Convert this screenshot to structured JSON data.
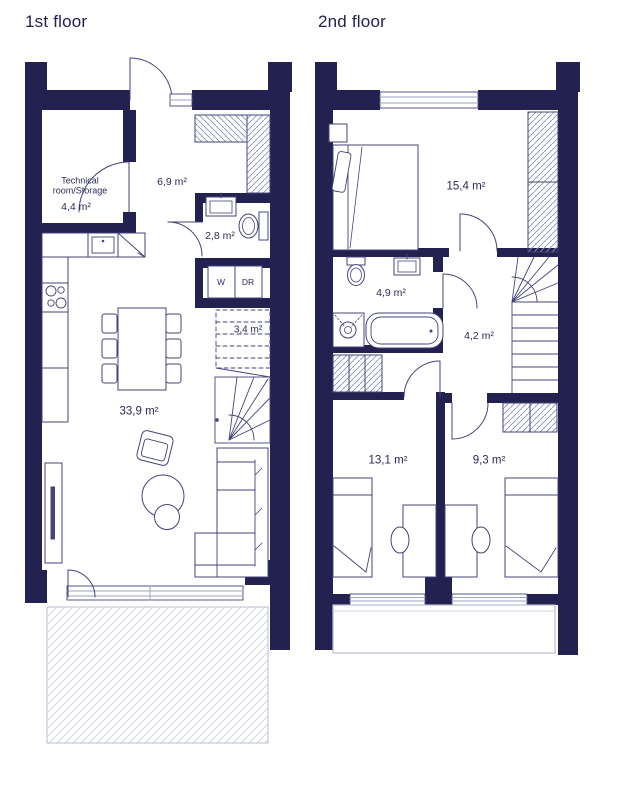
{
  "floor1": {
    "title": "1st floor",
    "technical_room": {
      "name": "Technical room/Storage",
      "area": "4,4 m²"
    },
    "hallway_area": "6,9 m²",
    "bathroom_area": "2,8 m²",
    "washer_label": "W",
    "dryer_label": "DR",
    "stairs_area": "3,4 m²",
    "living_area": "33,9 m²"
  },
  "floor2": {
    "title": "2nd floor",
    "bedroom_main_area": "15,4 m²",
    "bathroom_area": "4,9 m²",
    "hallway_area": "4,2 m²",
    "bedroom_left_area": "13,1 m²",
    "bedroom_right_area": "9,3 m²"
  },
  "colors": {
    "wall": "#232150",
    "furniture_line": "#44447a",
    "light_line": "#9fa3c4",
    "hatch": "#8d91b8",
    "terrace_hatch": "#d4d7e3",
    "label": "#2b2a5a"
  }
}
